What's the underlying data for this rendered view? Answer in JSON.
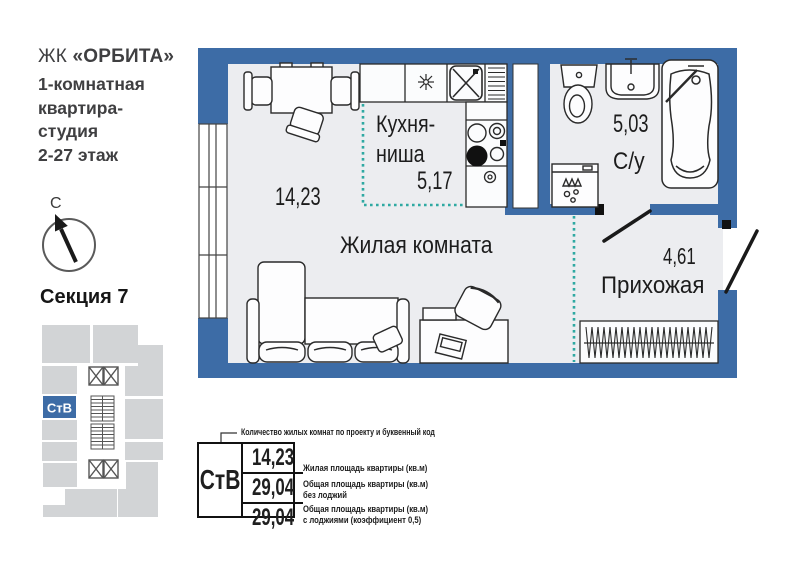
{
  "header": {
    "complex_prefix": "ЖК",
    "complex_name": "«ОРБИТА»",
    "subtitle": "1-комнатная\nквартира-\nстудия\n2-27 этаж"
  },
  "compass": {
    "north_label": "С"
  },
  "section": {
    "title": "Секция 7",
    "unit_code": "СтВ"
  },
  "plan": {
    "rooms": {
      "kitchen": {
        "label": "Кухня-\nниша",
        "area": "5,17"
      },
      "living": {
        "label": "Жилая комната",
        "area": "14,23"
      },
      "bathroom": {
        "label": "С/у",
        "area": "5,03"
      },
      "hallway": {
        "label": "Прихожая",
        "area": "4,61"
      }
    }
  },
  "legend": {
    "callout": "Количество жилых комнат по проекту и буквенный код",
    "unit_code": "СтВ",
    "rows": [
      {
        "value": "14,23",
        "label": "Жилая площадь квартиры (кв.м)"
      },
      {
        "value": "29,04",
        "label": "Общая площадь квартиры (кв.м)\nбез лоджий"
      },
      {
        "value": "29,04",
        "label": "Общая площадь квартиры (кв.м)\nс лоджиями (коэффициент 0,5)"
      }
    ]
  },
  "colors": {
    "wall": "#3d6ca6",
    "floor": "#ecedf0",
    "niche_boundary": "#2fa9a2",
    "section_block": "#d2d4d6"
  }
}
